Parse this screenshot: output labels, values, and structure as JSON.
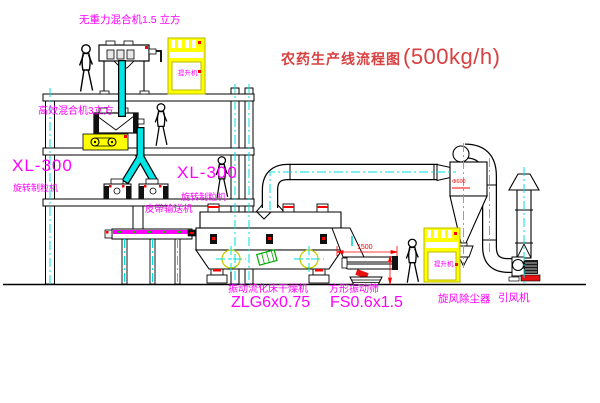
{
  "title": {
    "name": "农药生产线流程图",
    "capacity": "(500kg/h)"
  },
  "equipment": {
    "gravity_mixer": {
      "label": "无重力混合机1.5 立方"
    },
    "high_eff_mixer": {
      "label": "高效混合机3立方"
    },
    "granulator_left": {
      "model": "XL-300",
      "name": "旋转制粒机"
    },
    "granulator_right": {
      "model": "XL-300",
      "name": "旋转制粒机"
    },
    "belt_conveyor": {
      "label": "皮带输送机"
    },
    "fluid_bed_dryer": {
      "name": "振动流化床干燥机",
      "model": "ZLG6x0.75"
    },
    "square_sieve": {
      "name": "方形振动筛",
      "model": "FS0.6x1.5",
      "dimension": "1500"
    },
    "cyclone": {
      "label": "旋风除尘器",
      "spec": "Φ600"
    },
    "fan": {
      "label": "引风机"
    },
    "elevator_top": {
      "label": "提升机"
    },
    "elevator_right": {
      "label": "提升机"
    }
  },
  "colors": {
    "label_magenta": "#ff00ff",
    "title_red": "#d94040",
    "dimension_red": "#ff0000",
    "machine_yellow": "#ffff00",
    "centerline_cyan": "#00dfdf",
    "line_black": "#000000",
    "accent_green": "#00aa00"
  }
}
